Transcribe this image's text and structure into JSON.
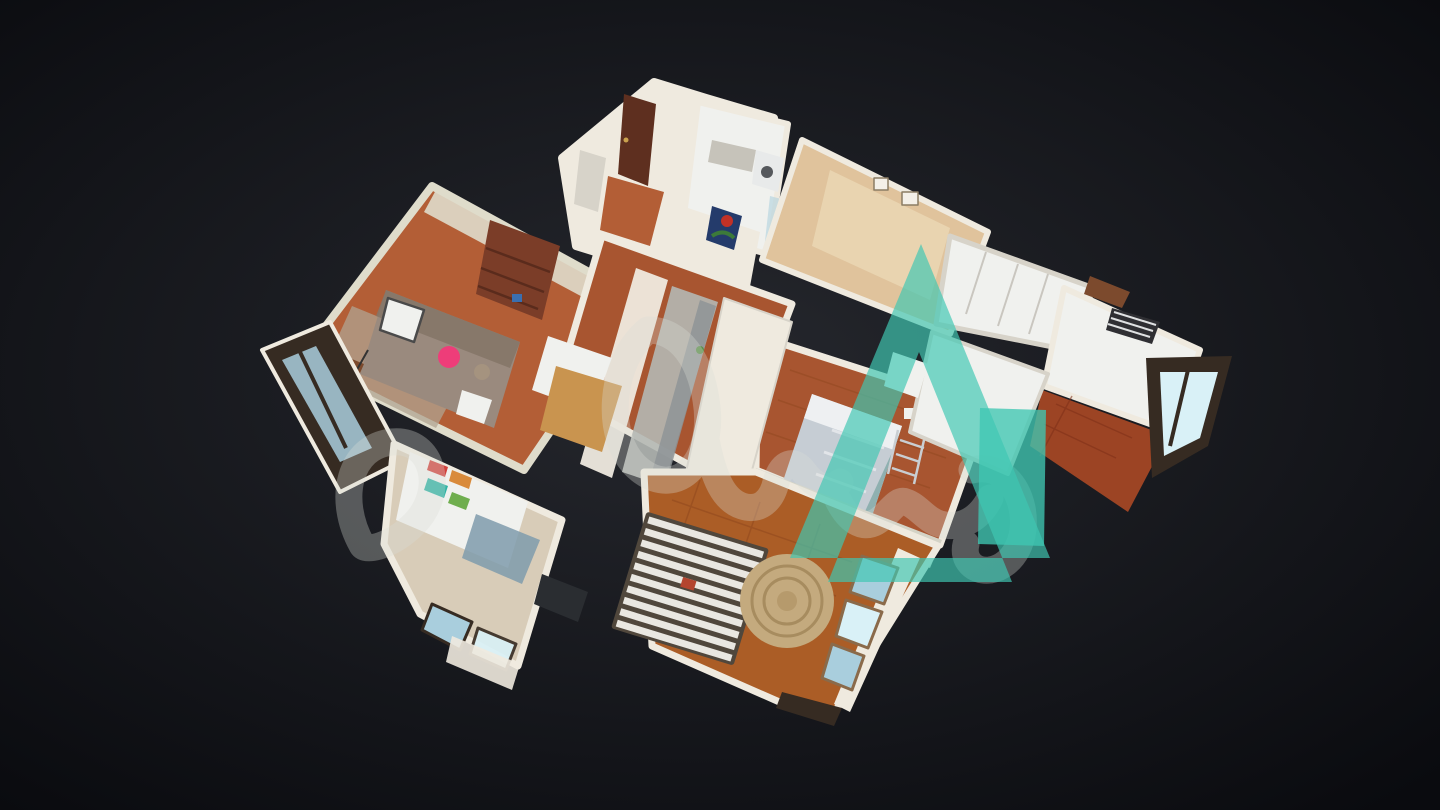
{
  "palette": {
    "bg_center": "#26282e",
    "bg_edge": "#0a0b0f",
    "wall_white": "#efeadf",
    "wall_top": "#d7d3c9",
    "wall_gray": "#c6c3ba",
    "wall_living": "#dfdccb",
    "wall_cream": "#e0c39c",
    "wall_cream_dark": "#cfa878",
    "counter_white": "#f0f1ee",
    "counter_gray": "#b4b8b4",
    "steel": "#8e9496",
    "floor_terracotta": "#b35e36",
    "floor_brick": "#a85530",
    "floor_parquet": "#ab5d26",
    "floor_tile_red": "#9c4424",
    "floor_pale": "#d8ccb8",
    "glass_blue": "#a9cedd",
    "glass_bright": "#d9f1f7",
    "frame_dark": "#362b22",
    "frame_wood": "#8a6a4a",
    "sofa": "#9a8a7e",
    "sofa_dark": "#857568",
    "pillow_pink": "#ee3d79",
    "wood_table": "#c9944f",
    "wood_dark": "#7c4a2d",
    "door_brown": "#5e2f1f",
    "shelf_wood": "#7b3d28",
    "bed_gray": "#c6cdd4",
    "bed_white": "#eef0f2",
    "bed_blanket": "#8fb0b0",
    "rug_round": "#c4aa7e",
    "rug_ring": "#a78c5f",
    "rug_blue": "#7f9bab",
    "rug_gray": "#b0a492",
    "slat_light": "#e9e7e1",
    "slat_dark": "#50473c",
    "laptop_dark": "#2a2d31",
    "art_navy": "#243b6b",
    "art_red": "#c23127",
    "art_green": "#3c7a39",
    "book_teal": "#2fb3a4",
    "book_green": "#6fae4e",
    "book_red": "#d2413c",
    "book_orange": "#d98a3a",
    "appliance_dark": "#3c4043",
    "tv_dark": "#2e2e30",
    "parquet_line": "#8a431c",
    "tile_line": "#7e3017"
  },
  "watermark": {
    "teal": "#3fc7b2",
    "teal_opacity": "0.68",
    "square_opacity": "0.78",
    "script": "#dadcd6",
    "script_opacity": "0.32"
  }
}
